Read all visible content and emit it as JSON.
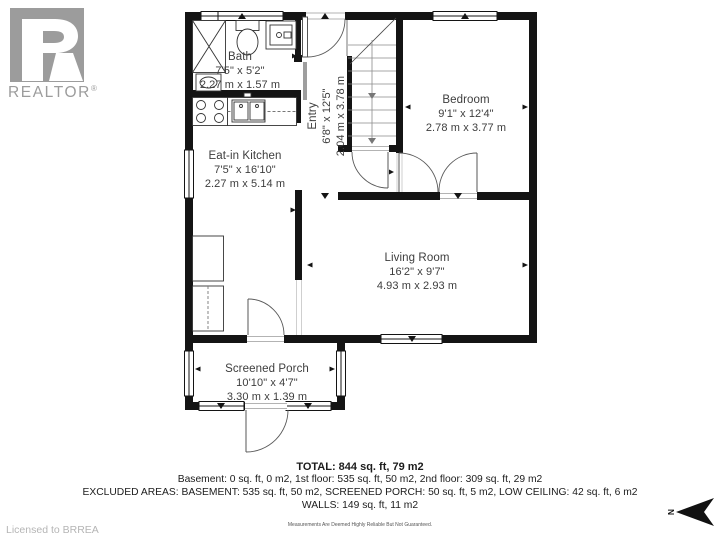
{
  "branding": {
    "logo_letter": "R",
    "logo_text": "REALTOR",
    "reg": "®",
    "licensed_to": "Licensed to BRREA"
  },
  "compass": {
    "label": "N"
  },
  "rooms": {
    "bath": {
      "name": "Bath",
      "imperial": "7'5\" x 5'2\"",
      "metric": "2.27 m x 1.57 m"
    },
    "entry": {
      "name": "Entry",
      "imperial": "6'8\" x 12'5\"",
      "metric": "2.04 m x 3.78 m"
    },
    "bedroom": {
      "name": "Bedroom",
      "imperial": "9'1\" x 12'4\"",
      "metric": "2.78 m x 3.77 m"
    },
    "kitchen": {
      "name": "Eat-in Kitchen",
      "imperial": "7'5\" x 16'10\"",
      "metric": "2.27 m x 5.14 m"
    },
    "living": {
      "name": "Living Room",
      "imperial": "16'2\" x 9'7\"",
      "metric": "4.93 m x 2.93 m"
    },
    "porch": {
      "name": "Screened Porch",
      "imperial": "10'10\" x 4'7\"",
      "metric": "3.30 m x 1.39 m"
    }
  },
  "summary": {
    "total": "TOTAL: 844 sq. ft, 79 m2",
    "floors": "Basement: 0 sq. ft, 0 m2, 1st floor: 535 sq. ft, 50 m2, 2nd floor: 309 sq. ft, 29 m2",
    "excluded": "EXCLUDED AREAS: BASEMENT: 535 sq. ft, 50 m2, SCREENED PORCH: 50 sq. ft, 5 m2, LOW CEILING: 42 sq. ft, 6 m2",
    "walls": "WALLS: 149 sq. ft, 11 m2",
    "disclaimer": "Measurements Are Deemed Highly Reliable But Not Guaranteed."
  },
  "colors": {
    "wall": "#141414",
    "logo_gray": "#9c9c9c",
    "label": "#3d3d3d",
    "muted": "#b5b5b5"
  }
}
